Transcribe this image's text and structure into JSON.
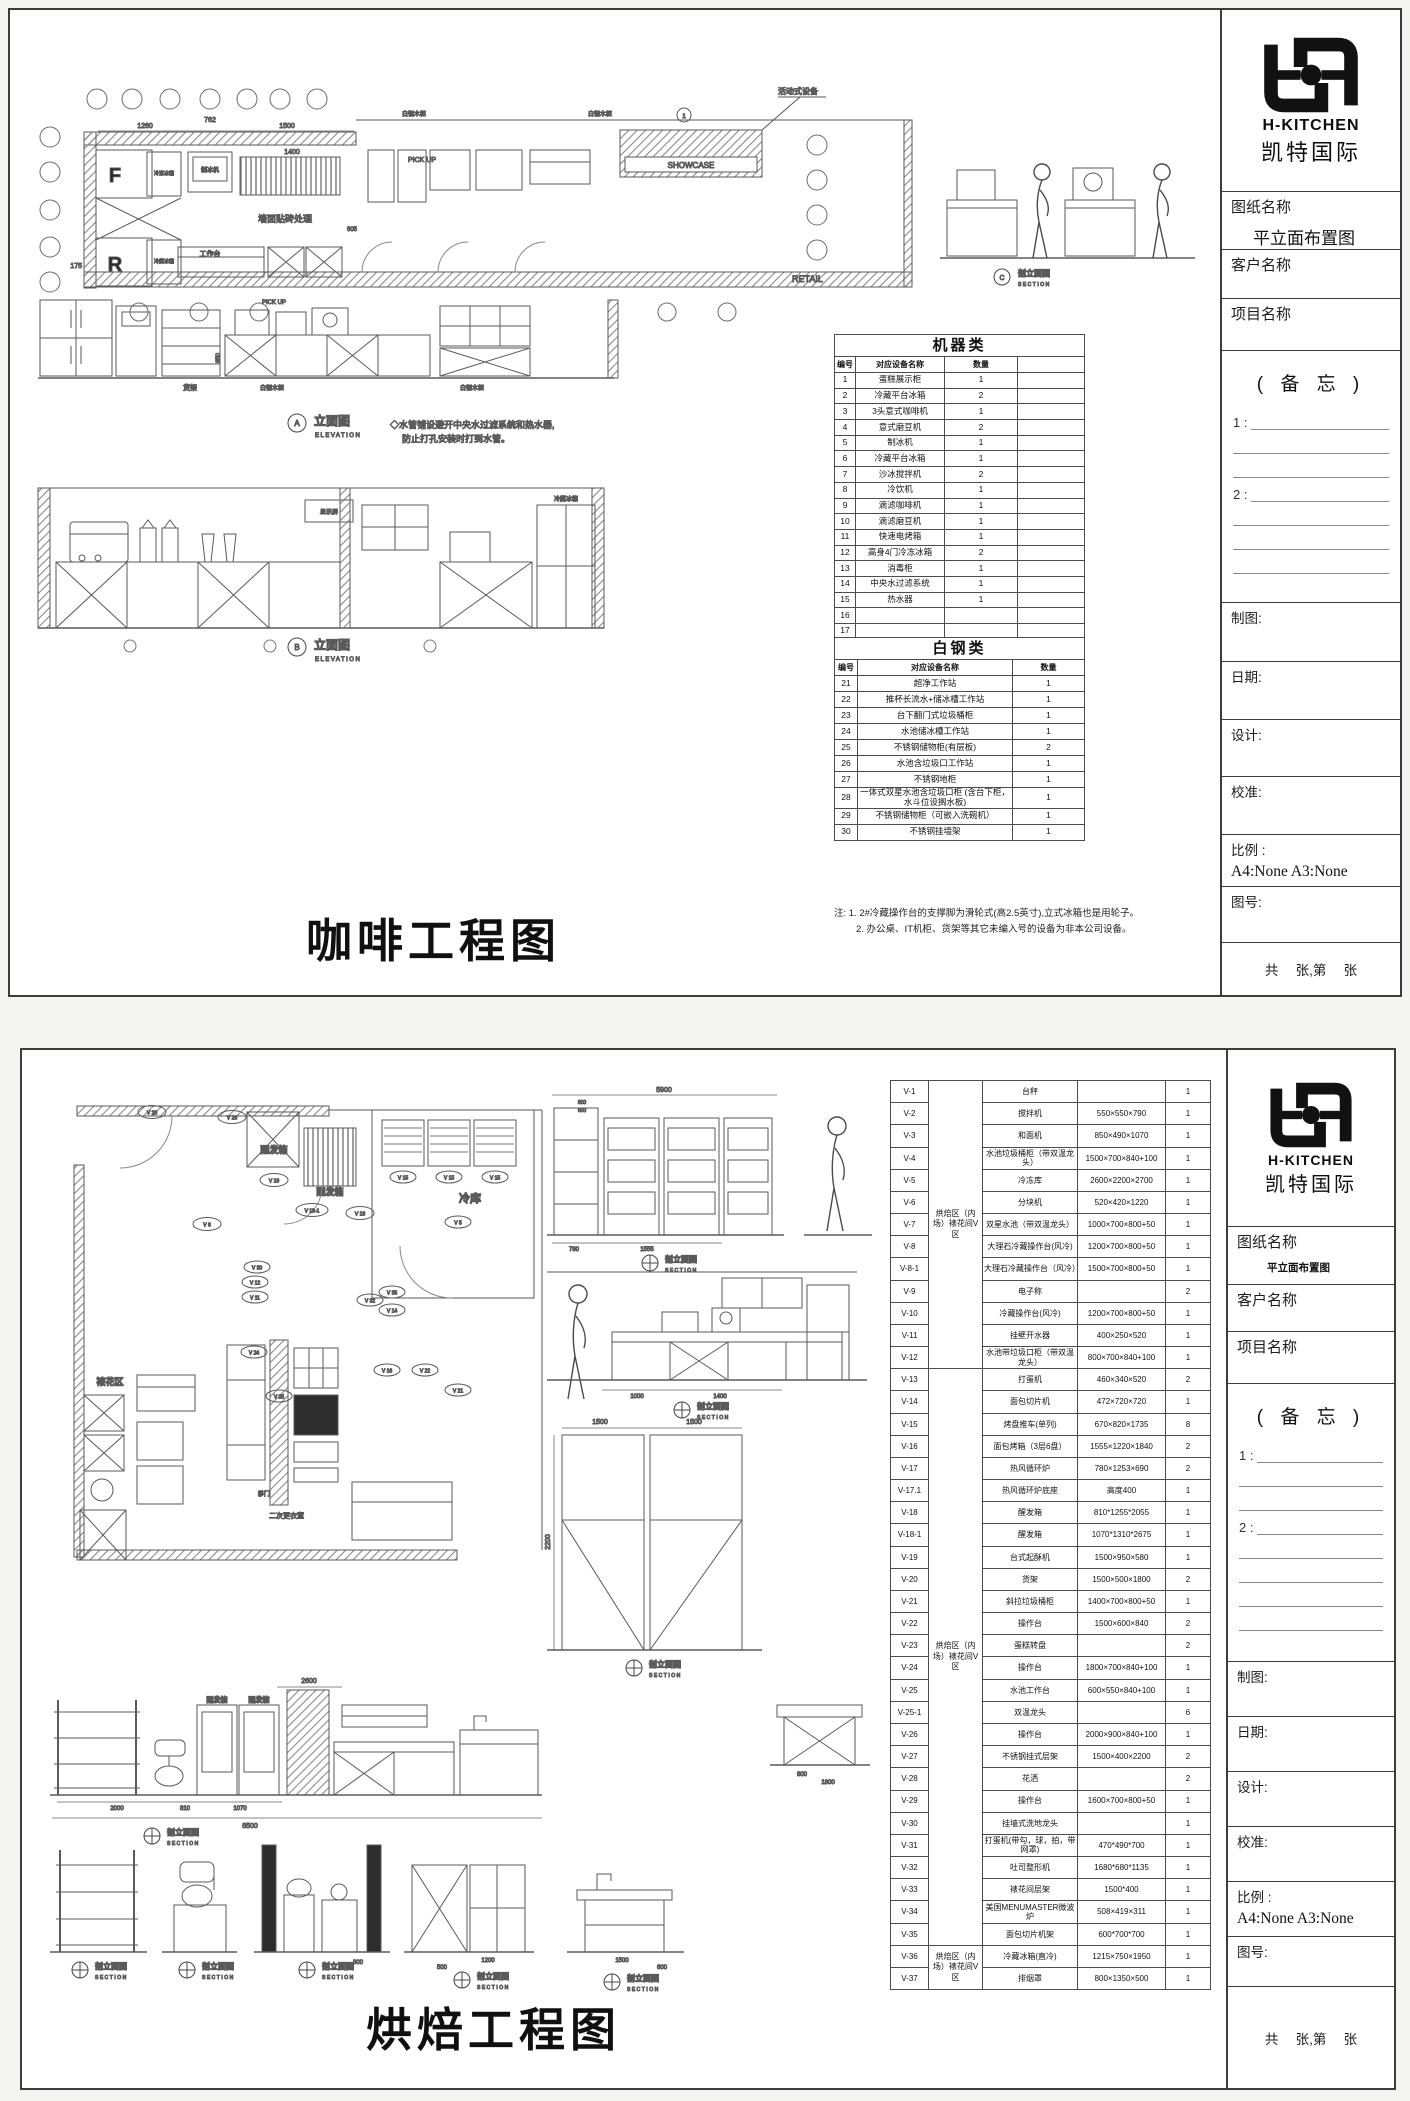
{
  "brand": {
    "name": "H-KITCHEN",
    "cn": "凯特国际"
  },
  "tb": {
    "drawing_name_label": "图纸名称",
    "drawing_name_value": "平立面布置图",
    "client_label": "客户名称",
    "project_label": "项目名称",
    "memo_title": "( 备 忘 )",
    "memo_item1": "1 : ",
    "memo_item2": "2 : ",
    "draft_label": "制图:",
    "date_label": "日期:",
    "design_label": "设计:",
    "check_label": "校准:",
    "scale_label": "比例 :",
    "scale_value": "A4:None  A3:None",
    "figno_label": "图号:",
    "pages_label": "共　 张,第　 张"
  },
  "cap": {
    "elevation_cn": "立面图",
    "elevation_en": "ELEVATION",
    "section_cn": "剖立面图",
    "section_en": "SECTION"
  },
  "s1": {
    "big_title": "咖啡工程图",
    "plan": {
      "movable": "活动式设备",
      "cabinet": "白钢木柜",
      "pickup": "PICK UP",
      "showcase": "SHOWCASE",
      "retail": "RETAIL",
      "wall_tile": "墙面贴砖处理",
      "ice_maker": "制冰机",
      "worktable": "工作台",
      "freezer_f": "F",
      "fridge_r": "R",
      "freezer_label": "冷冻冰箱",
      "fridge_label": "冷藏冰箱",
      "showcase_tag": "1",
      "dims": [
        "1260",
        "762",
        "1500",
        "1400",
        "605",
        "175"
      ]
    },
    "elev_a": {
      "letter": "A",
      "shelf": "货架",
      "cabinet": "白钢木柜",
      "pickup": "PICK UP",
      "dim": "850"
    },
    "elev_b": {
      "letter": "B",
      "screen": "显示屏",
      "fridge": "冷藏冰箱"
    },
    "section_letter": "C",
    "water_note": [
      "◇水管铺设避开中央水过滤系统和热水器,",
      "防止打孔安装时打到水管。"
    ],
    "machine_table": {
      "title": "机器类",
      "headers": [
        "编号",
        "对应设备名称",
        "数量",
        ""
      ],
      "rows": [
        [
          "1",
          "蛋糕展示柜",
          "1"
        ],
        [
          "2",
          "冷藏平台冰箱",
          "2"
        ],
        [
          "3",
          "3头意式咖啡机",
          "1"
        ],
        [
          "4",
          "意式磨豆机",
          "2"
        ],
        [
          "5",
          "制冰机",
          "1"
        ],
        [
          "6",
          "冷藏平台冰箱",
          "1"
        ],
        [
          "7",
          "沙冰搅拌机",
          "2"
        ],
        [
          "8",
          "冷饮机",
          "1"
        ],
        [
          "9",
          "滴滤咖啡机",
          "1"
        ],
        [
          "10",
          "滴滤磨豆机",
          "1"
        ],
        [
          "11",
          "快速电烤箱",
          "1"
        ],
        [
          "12",
          "高身4门冷冻冰箱",
          "2"
        ],
        [
          "13",
          "消毒柜",
          "1"
        ],
        [
          "14",
          "中央水过滤系统",
          "1"
        ],
        [
          "15",
          "热水器",
          "1"
        ],
        [
          "16",
          "",
          ""
        ],
        [
          "17",
          "",
          ""
        ]
      ]
    },
    "steel_table": {
      "title": "白钢类",
      "headers": [
        "编号",
        "对应设备名称",
        "数量"
      ],
      "rows": [
        [
          "21",
          "超净工作站",
          "1"
        ],
        [
          "22",
          "推杯长流水+储冰槽工作站",
          "1"
        ],
        [
          "23",
          "台下翻门式垃圾桶柜",
          "1"
        ],
        [
          "24",
          "水池储冰槽工作站",
          "1"
        ],
        [
          "25",
          "不锈钢储物柜(有层板)",
          "2"
        ],
        [
          "26",
          "水池含垃圾口工作站",
          "1"
        ],
        [
          "27",
          "不锈钢地柜",
          "1"
        ],
        [
          "28",
          "一体式双星水池含垃圾口柜 (含台下柜，水斗位设搁水板)",
          "1"
        ],
        [
          "29",
          "不锈钢储物柜（可嵌入洗碗机）",
          "1"
        ],
        [
          "30",
          "不锈钢挂墙架",
          "1"
        ]
      ]
    },
    "notes": [
      "注: 1. 2#冷藏操作台的支撑脚为滑轮式(高2.5英寸),立式冰箱也是用轮子。",
      "2. 办公桌、IT机柜、货架等其它未编入号的设备为非本公司设备。"
    ]
  },
  "s2": {
    "big_title": "烘焙工程图",
    "plan": {
      "proofer": "醒发箱",
      "cold_room": "冷库",
      "deco_area": "裱花区",
      "changing": "二次更衣室",
      "sliding_door": "移门",
      "markers": [
        "V 20",
        "V 26",
        "V 19",
        "V 6",
        "V 18-1",
        "V 18",
        "V 15",
        "V 15",
        "V 15",
        "V 5",
        "V 30",
        "V 12",
        "V 11",
        "V 24",
        "V 32",
        "V 35",
        "V 14",
        "V 16",
        "V 22",
        "V 21",
        "V 25"
      ]
    },
    "dims": [
      "5900",
      "800",
      "600",
      "780",
      "1555",
      "1000",
      "1400",
      "1500",
      "1500",
      "2200",
      "2600",
      "2000",
      "810",
      "1070",
      "8500",
      "800",
      "1800",
      "800",
      "1200",
      "500",
      "1500",
      "600"
    ],
    "equipment_table": {
      "groups": [
        {
          "label": "烘焙区（内场）裱花间V区",
          "from": 0,
          "to": 12
        },
        {
          "label": "烘焙区（内场）裱花间V区",
          "from": 13,
          "to": 38
        },
        {
          "label": "烘焙区（内场）裱花间V区",
          "from": 39,
          "to": 40
        }
      ],
      "rows": [
        [
          "V-1",
          "台秤",
          "",
          "1"
        ],
        [
          "V-2",
          "搅拌机",
          "550×550×790",
          "1"
        ],
        [
          "V-3",
          "和面机",
          "850×490×1070",
          "1"
        ],
        [
          "V-4",
          "水池垃圾桶柜（带双温龙头）",
          "1500×700×840+100",
          "1"
        ],
        [
          "V-5",
          "冷冻库",
          "2600×2200×2700",
          "1"
        ],
        [
          "V-6",
          "分块机",
          "520×420×1220",
          "1"
        ],
        [
          "V-7",
          "双星水池（带双温龙头）",
          "1000×700×800+50",
          "1"
        ],
        [
          "V-8",
          "大理石冷藏操作台(风冷)",
          "1200×700×800+50",
          "1"
        ],
        [
          "V-8-1",
          "大理石冷藏操作台（风冷）",
          "1500×700×800+50",
          "1"
        ],
        [
          "V-9",
          "电子称",
          "",
          "2"
        ],
        [
          "V-10",
          "冷藏操作台(风冷)",
          "1200×700×800+50",
          "1"
        ],
        [
          "V-11",
          "挂壁开水器",
          "400×250×520",
          "1"
        ],
        [
          "V-12",
          "水池带垃圾口柜（带双温龙头）",
          "800×700×840+100",
          "1"
        ],
        [
          "V-13",
          "打蛋机",
          "460×340×520",
          "2"
        ],
        [
          "V-14",
          "面包切片机",
          "472×720×720",
          "1"
        ],
        [
          "V-15",
          "烤盘推车(单列)",
          "670×820×1735",
          "8"
        ],
        [
          "V-16",
          "面包烤箱（3层6盘）",
          "1555×1220×1840",
          "2"
        ],
        [
          "V-17",
          "热风循环炉",
          "780×1253×690",
          "2"
        ],
        [
          "V-17.1",
          "热风循环炉底座",
          "高度400",
          "1"
        ],
        [
          "V-18",
          "醒发箱",
          "810*1255*2055",
          "1"
        ],
        [
          "V-18-1",
          "醒发箱",
          "1070*1310*2675",
          "1"
        ],
        [
          "V-19",
          "台式起酥机",
          "1500×950×580",
          "1"
        ],
        [
          "V-20",
          "货架",
          "1500×500×1800",
          "2"
        ],
        [
          "V-21",
          "斜拉垃圾桶柜",
          "1400×700×800+50",
          "1"
        ],
        [
          "V-22",
          "操作台",
          "1500×600×840",
          "2"
        ],
        [
          "V-23",
          "蛋糕转盘",
          "",
          "2"
        ],
        [
          "V-24",
          "操作台",
          "1800×700×840+100",
          "1"
        ],
        [
          "V-25",
          "水池工作台",
          "600×550×840+100",
          "1"
        ],
        [
          "V-25-1",
          "双温龙头",
          "",
          "6"
        ],
        [
          "V-26",
          "操作台",
          "2000×900×840+100",
          "1"
        ],
        [
          "V-27",
          "不锈钢挂式层架",
          "1500×400×2200",
          "2"
        ],
        [
          "V-28",
          "花洒",
          "",
          "2"
        ],
        [
          "V-29",
          "操作台",
          "1600×700×800+50",
          "1"
        ],
        [
          "V-30",
          "挂墙式洗地龙头",
          "",
          "1"
        ],
        [
          "V-31",
          "打蛋机(带勾，球，拍，带网罩)",
          "470*490*700",
          "1"
        ],
        [
          "V-32",
          "吐司整形机",
          "1680*680*1135",
          "1"
        ],
        [
          "V-33",
          "裱花间层架",
          "1500*400",
          "1"
        ],
        [
          "V-34",
          "美国MENUMASTER微波炉",
          "508×419×311",
          "1"
        ],
        [
          "V-35",
          "面包切片机架",
          "600*700*700",
          "1"
        ],
        [
          "V-36",
          "冷藏冰箱(直冷)",
          "1215×750×1950",
          "1"
        ],
        [
          "V-37",
          "排烟罩",
          "800×1350×500",
          "1"
        ]
      ]
    }
  }
}
